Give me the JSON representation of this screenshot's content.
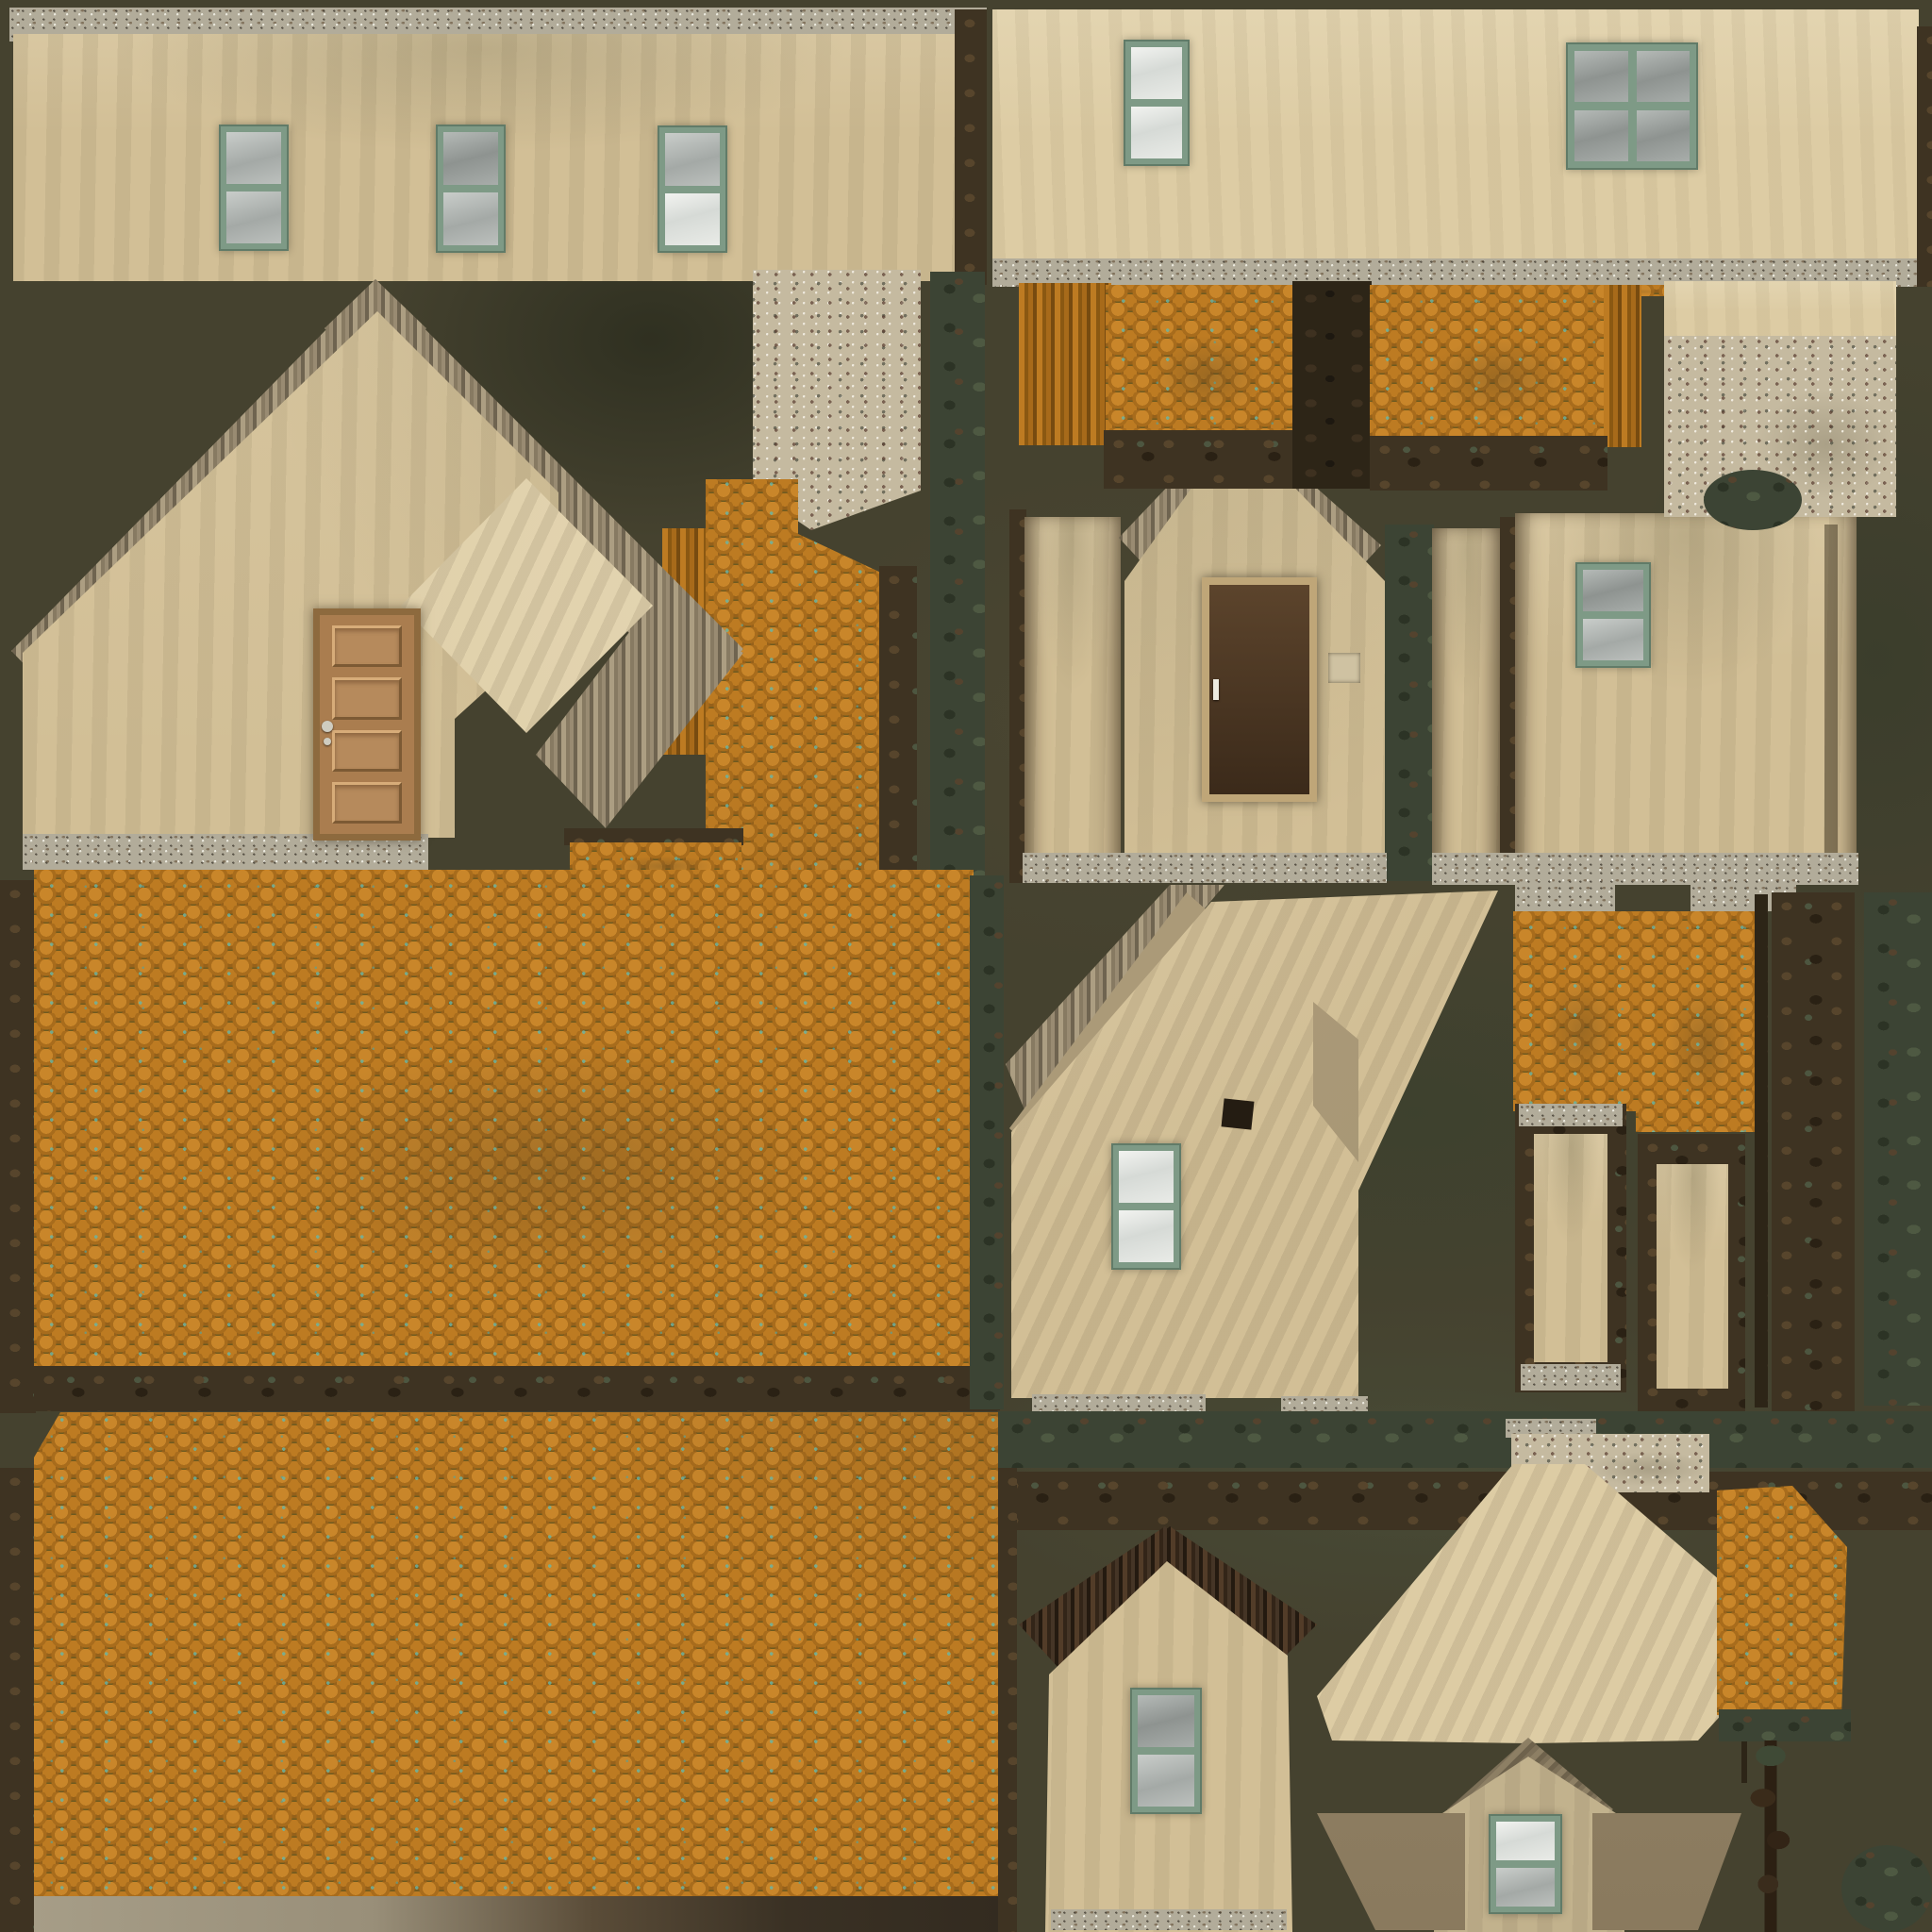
{
  "meta": {
    "kind": "texture-atlas",
    "subject": "Hand-painted UV texture atlas for a rustic plastered house with orange scalloped shingle roofs",
    "canvas": "2048x2048"
  },
  "palette": {
    "background": "#45422f",
    "plaster": "#d2bf96",
    "plaster_light": "#ddcca4",
    "stone": "#b2ac9a",
    "stone_speckle": "#c5baa0",
    "shingle_base": "#6e5a20",
    "shingle_light": "#c9862a",
    "shingle_mid": "#a86c1c",
    "moss_teal": "#63b9ad",
    "window_frame": "#7e9a86",
    "glass_white": "#eef0ec",
    "glass_gray": "#949997",
    "door_wood": "#aa7d4f",
    "door_dark": "#4a3522",
    "trim_brown": "#3e3322",
    "trim_green": "#3c4434",
    "khaki": "#b8a782",
    "bleed_tan": "#998b72"
  },
  "atlas": {
    "islands": [
      {
        "id": "wall-strip-long-top-left",
        "kind": "plaster wall strip with stone footing",
        "windows": 3,
        "doors": 0
      },
      {
        "id": "wall-strip-top-right",
        "kind": "plaster wall strip with stone footing",
        "windows": 2,
        "doors": 0
      },
      {
        "id": "gable-wall-large",
        "kind": "plaster gable end with wooden panel door",
        "windows": 0,
        "doors": 1
      },
      {
        "id": "speckled-plaster-patch-left",
        "kind": "speckled render patch",
        "windows": 0,
        "doors": 0
      },
      {
        "id": "weathered-ridge-strip",
        "kind": "dark mossy trim strip",
        "windows": 0,
        "doors": 0
      },
      {
        "id": "shingle-column",
        "kind": "orange shingle strip",
        "windows": 0,
        "doors": 0
      },
      {
        "id": "roof-slope-upper",
        "kind": "large orange scalloped shingle roof",
        "windows": 0,
        "doors": 0
      },
      {
        "id": "roof-slope-lower",
        "kind": "large orange scalloped shingle roof",
        "windows": 0,
        "doors": 0
      },
      {
        "id": "porch-gable-with-dark-door",
        "kind": "plaster gable end with dark door and switch box",
        "windows": 0,
        "doors": 1
      },
      {
        "id": "side-wall-with-window",
        "kind": "plaster wall",
        "windows": 1,
        "doors": 0
      },
      {
        "id": "dormer-shingle-pair",
        "kind": "two small shingle roof patches",
        "windows": 0,
        "doors": 0
      },
      {
        "id": "speckled-plaster-patch-right",
        "kind": "speckled render patch",
        "windows": 0,
        "doors": 0
      },
      {
        "id": "eave-corner-wall",
        "kind": "plaster wall under diagonal eave",
        "windows": 1,
        "doors": 0
      },
      {
        "id": "chimney-pillars",
        "kind": "two plaster pillars with shingle caps and stone bands",
        "windows": 0,
        "doors": 0
      },
      {
        "id": "mossy-trim-columns",
        "kind": "dark mossy vertical trim strips",
        "windows": 0,
        "doors": 0
      },
      {
        "id": "bottom-gable-with-window",
        "kind": "plaster gable end",
        "windows": 1,
        "doors": 0
      },
      {
        "id": "arrow-roof-wedge",
        "kind": "roof underside wedge piece",
        "windows": 0,
        "doors": 0
      },
      {
        "id": "small-gable-with-window",
        "kind": "plaster gable end",
        "windows": 1,
        "doors": 0
      },
      {
        "id": "small-shingle-patch",
        "kind": "orange shingle patch with branch trim",
        "windows": 0,
        "doors": 0
      }
    ],
    "totals": {
      "windows": 10,
      "doors": 2
    }
  }
}
